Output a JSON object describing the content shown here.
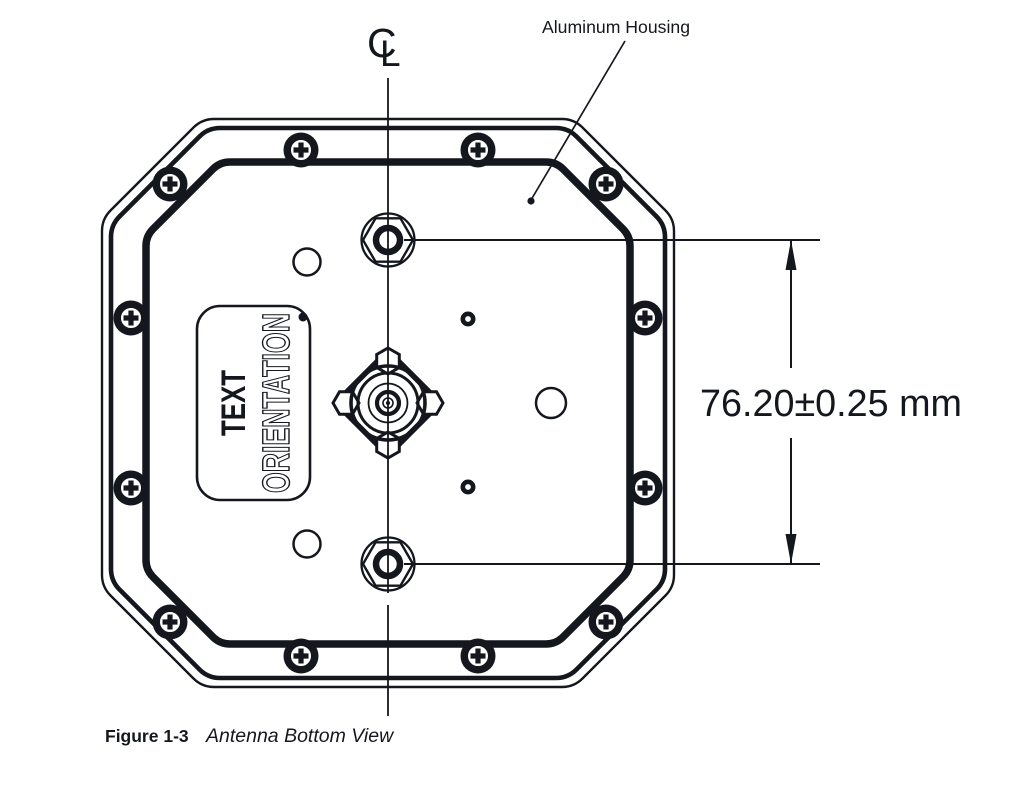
{
  "figure": {
    "centerline_symbol": {
      "c": "C",
      "l": "L"
    },
    "housing_annotation": "Aluminum Housing",
    "engraving": {
      "line1": "TEXT",
      "line2": "ORIENTATION"
    },
    "dimension_label": "76.20±0.25 mm",
    "caption": {
      "label": "Figure 1-3",
      "title": "Antenna Bottom View"
    }
  },
  "colors": {
    "ink": "#14171d",
    "paper": "#ffffff"
  }
}
